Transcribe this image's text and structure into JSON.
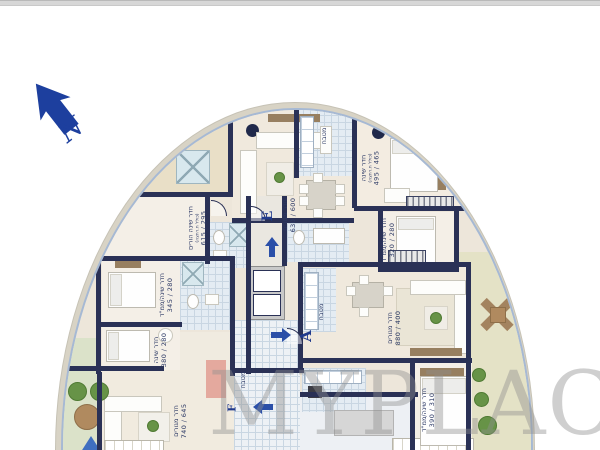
{
  "compass": {
    "label": "N",
    "color": "#1d3f9e"
  },
  "watermark": {
    "text": "MYPLACE"
  },
  "apartments": [
    {
      "letter": "E"
    },
    {
      "letter": "A"
    },
    {
      "letter": "F"
    }
  ],
  "palette": {
    "wall": "#2a3156",
    "arrow_blue": "#2b4fa8",
    "band": "#d8d3c5",
    "accent_line": "#a6b9d4",
    "floor": "#ede6da",
    "terrace_sand": "#e9dfc7",
    "terrace_green": "#dbe2c9"
  },
  "rooms": [
    {
      "label": "חדר שינה הורים",
      "note": "(כולל ח.רחצה)",
      "dims": "615 / 295"
    },
    {
      "label": "חדר מגורים",
      "dims": "630 / 600"
    },
    {
      "label": "מטבח"
    },
    {
      "label": "חדר שינה",
      "note": "(כולל ח.רחצה)",
      "dims": "495 / 465"
    },
    {
      "label": "חדר שינה/ממ\"ד",
      "dims": "320 / 280"
    },
    {
      "label": "חדר שינה/ממ\"ד",
      "dims": "345 / 280"
    },
    {
      "label": "חדר שינה",
      "dims": "380 / 280"
    },
    {
      "label": "חדר מגורים",
      "dims": "740 / 645"
    },
    {
      "label": "מטבח"
    },
    {
      "label": "חדר מגורים",
      "dims": "880 / 400"
    },
    {
      "label": "מטבח"
    },
    {
      "label": "חדר שינה/ממ\"ד",
      "dims": "390 / 310"
    }
  ]
}
